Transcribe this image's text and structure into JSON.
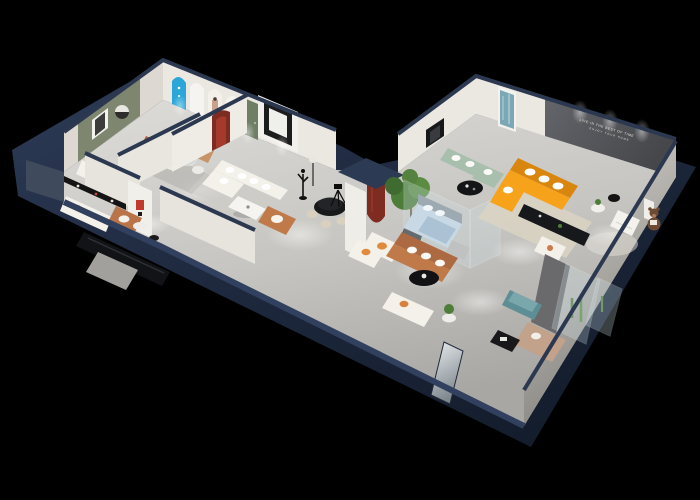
{
  "scene": {
    "title": "3D isometric cutaway render of a furniture showroom floor plan on black background",
    "description": "Dollhouse view of a V-shaped showroom with dark navy exterior walls, light grey floors, white interior walls, arched display niches, glass display rooms and staged sofa sets",
    "wall_sign": {
      "line1": "LIVE IN THE BEST OF TIME",
      "line2": "ENJOY YOUR HOME"
    }
  },
  "palette": {
    "bg": "#000000",
    "wallNavy": "#233046",
    "wallNavyDark": "#161f2e",
    "wallNavyLight": "#31405e",
    "floor": "#c9c7c3",
    "wallWhite": "#ebe8e2",
    "oliveWall": "#7e8670",
    "darkFeatureWall": "#56575b",
    "cyanArch": "#2aa6d8",
    "redArch": "#7e2b22",
    "orangeSofa": "#f6a21b",
    "sageSofa": "#a9bfad",
    "tanSofa": "#c79468",
    "caramel": "#c07a4a",
    "whiteSofa": "#f3f1ea",
    "blueBed": "#c6d5e2",
    "tealOttoman": "#5e8e95",
    "greenPlant": "#4e7d3a",
    "bearBrown": "#6f4a33",
    "signText": "#e8e6df"
  },
  "inventory": {
    "left_wing": [
      "olive accent wall with mirror and round art",
      "arched display wall with cyan arch, poster arches and green door",
      "red arch niche",
      "tan leather sofa",
      "terracotta ottoman",
      "white L-shaped sectional with pillows",
      "caramel armchair",
      "white coffee table",
      "dancer statue",
      "black sideboard console",
      "white sofa with orange cushions",
      "black metal shelf",
      "white column with red logo"
    ],
    "center": [
      "black round dining table with cream chairs",
      "camera tripod",
      "white pillar with maroon arch sculpture",
      "large potted tree",
      "white armchair with orange pillow"
    ],
    "right_wing": [
      "dark grey feature wall with tiny white sign",
      "blue abstract wall art",
      "orange L-shaped sectional sofa with white pillows",
      "black media console",
      "sage green sectional sofa",
      "black round coffee table",
      "glass bedroom display with light blue bed",
      "white cube armchair",
      "brown teddy bear",
      "teal ottoman",
      "beige chaise lounge",
      "glass display cases with cacti",
      "mirror entry door"
    ]
  }
}
